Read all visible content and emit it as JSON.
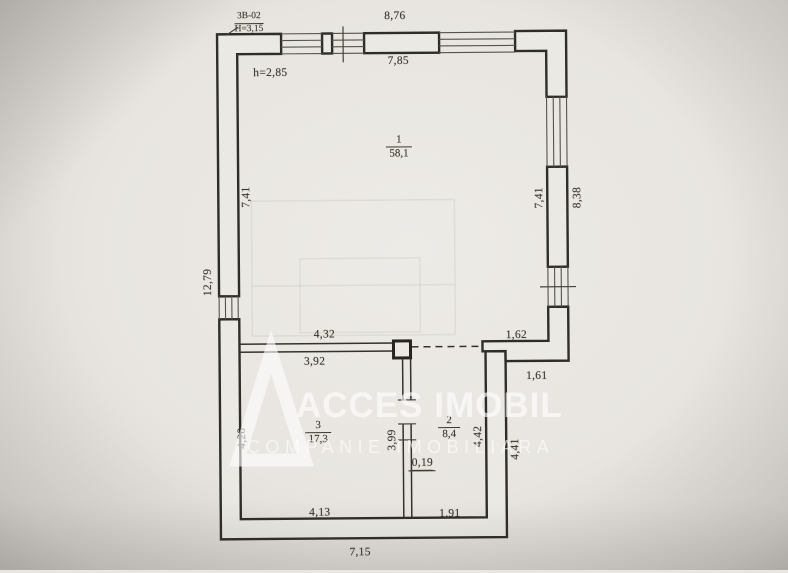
{
  "watermark": {
    "brand": "ACCES IMOBIL",
    "tagline": "COMPANIE IMOBILIARA"
  },
  "title_block": {
    "code": "3B-02",
    "building_height": "H=3,15",
    "ceiling_height": "h=2,85"
  },
  "rooms": [
    {
      "number": "1",
      "area": "58,1",
      "x": 400,
      "y": 147,
      "bar_w": 26
    },
    {
      "number": "3",
      "area": "17,3",
      "x": 317,
      "y": 432,
      "bar_w": 26
    },
    {
      "number": "2",
      "area": "8,4",
      "x": 448,
      "y": 428,
      "bar_w": 22
    }
  ],
  "dimensions": [
    {
      "text": "8,76",
      "x": 397,
      "y": 16,
      "rot": 0
    },
    {
      "text": "7,85",
      "x": 400,
      "y": 61,
      "rot": 0
    },
    {
      "text": "7,41",
      "x": 247,
      "y": 196,
      "rot": 1
    },
    {
      "text": "12,79",
      "x": 208,
      "y": 281,
      "rot": 1
    },
    {
      "text": "7,41",
      "x": 540,
      "y": 199,
      "rot": 1
    },
    {
      "text": "8,38",
      "x": 578,
      "y": 199,
      "rot": 1
    },
    {
      "text": "4,32",
      "x": 324,
      "y": 334,
      "rot": 0
    },
    {
      "text": "3,92",
      "x": 314,
      "y": 361,
      "rot": 0
    },
    {
      "text": "1,62",
      "x": 516,
      "y": 336,
      "rot": 0
    },
    {
      "text": "1,61",
      "x": 536,
      "y": 377,
      "rot": 0
    },
    {
      "text": "4,20",
      "x": 241,
      "y": 437,
      "rot": 1
    },
    {
      "text": "3,99",
      "x": 391,
      "y": 440,
      "rot": 1
    },
    {
      "text": "4,42",
      "x": 477,
      "y": 437,
      "rot": 1
    },
    {
      "text": "4,41",
      "x": 514,
      "y": 450,
      "rot": 1
    },
    {
      "text": "0,19",
      "x": 421,
      "y": 464,
      "rot": 0,
      "underline": true
    },
    {
      "text": "4,13",
      "x": 318,
      "y": 512,
      "rot": 0
    },
    {
      "text": "1,91",
      "x": 448,
      "y": 514,
      "rot": 0
    },
    {
      "text": "7,15",
      "x": 358,
      "y": 552,
      "rot": 0
    }
  ],
  "colors": {
    "paper": "#e9e6e1",
    "ink": "#2f2d27",
    "label_ink": "#3b382f",
    "watermark": "#ffffff"
  }
}
